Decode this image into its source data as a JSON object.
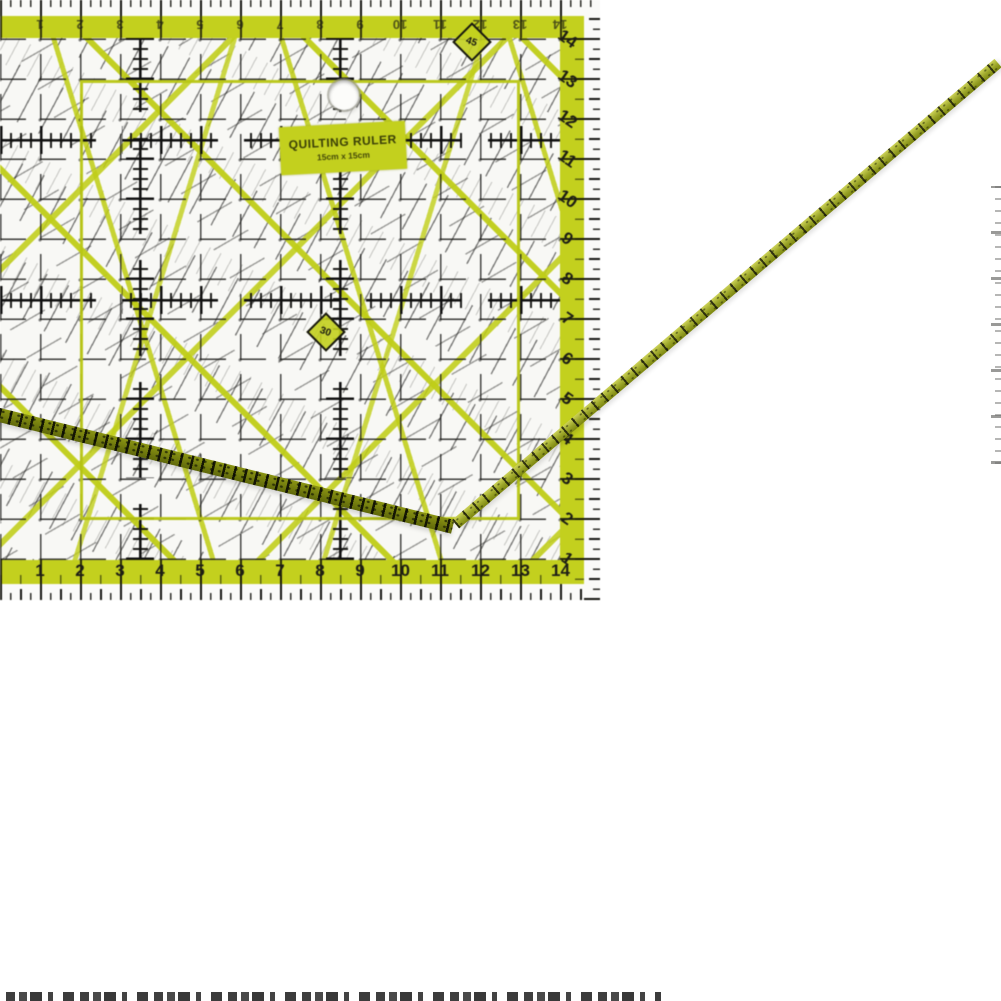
{
  "alt": "Transparent acrylic quilting ruler with lime-green grid printing, photographed at a steep angle on a white background",
  "ruler": {
    "label": {
      "line1": "QUILTING RULER",
      "line2": "15cm x 15cm"
    },
    "scales": {
      "bottom": [
        1,
        2,
        3,
        4,
        5,
        6,
        7,
        8,
        9,
        10,
        11,
        12,
        13,
        14
      ],
      "right": [
        1,
        2,
        3,
        4,
        5,
        6,
        7,
        8,
        9,
        10,
        11,
        12,
        13,
        14
      ],
      "top": [
        1,
        2,
        3,
        4,
        5,
        6,
        7,
        8,
        9,
        10,
        11,
        12,
        13,
        14
      ]
    },
    "angle_markers": [
      {
        "label": "30"
      },
      {
        "label": "45"
      }
    ],
    "colors": {
      "lime": "#c3d01e",
      "edge_olive": "#76800e",
      "ink": "#1b1b16",
      "surface": "#f7f7f4",
      "background": "#ffffff"
    }
  },
  "fragments": {
    "bottom_caption_legible": false,
    "right_edge_ticks_present": true
  }
}
